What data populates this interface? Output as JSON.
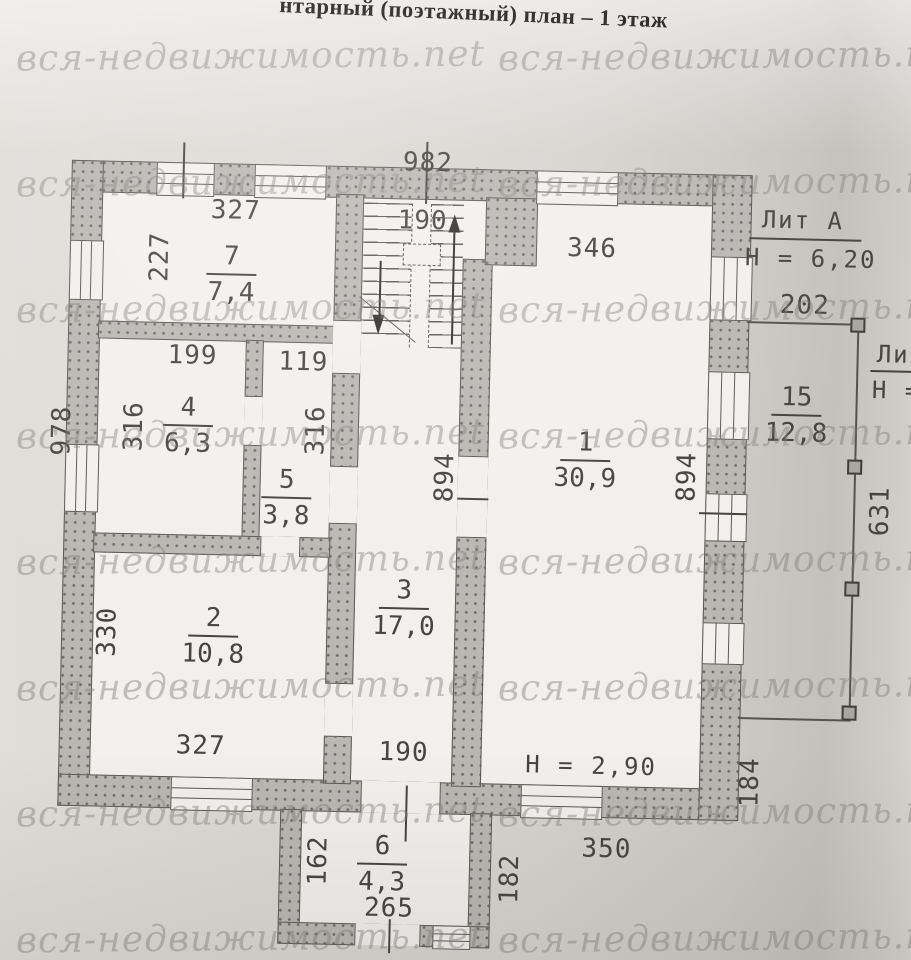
{
  "title": "нтарный (поэтажный) план – 1 этаж",
  "watermark": {
    "text": "вся-недвижимость.net"
  },
  "rooms": {
    "r1": {
      "number": "1",
      "area": "30,9"
    },
    "r2": {
      "number": "2",
      "area": "10,8"
    },
    "r3": {
      "number": "3",
      "area": "17,0"
    },
    "r4": {
      "number": "4",
      "area": "6,3"
    },
    "r5": {
      "number": "5",
      "area": "3,8"
    },
    "r6": {
      "number": "6",
      "area": "4,3"
    },
    "r7": {
      "number": "7",
      "area": "7,4"
    },
    "r15": {
      "number": "15",
      "area": "12,8"
    }
  },
  "dims": {
    "overall_top": "982",
    "room7_top": "327",
    "hall_top": "190",
    "room1_top": "346",
    "room7_left": "227",
    "room4_top": "199",
    "room5_top": "119",
    "room4_left": "316",
    "room5_right": "316",
    "overall_left": "978",
    "hall_right": "894",
    "room1_right": "894",
    "room2_left": "330",
    "room2_bottom": "327",
    "hall_bottom": "190",
    "room6_left": "162",
    "room6_bottom": "265",
    "room6_right": "182",
    "bottom_right": "350",
    "right_lower": "184",
    "porch_top": "202",
    "porch_right": "631"
  },
  "annotations": {
    "building_liter": "Лит А",
    "building_height": "Н = 6,20",
    "room1_height": "Н = 2,90",
    "porch_liter": "Лит",
    "porch_height": "Н ="
  },
  "colors": {
    "wall": "#b9b7b2",
    "line": "#55534f",
    "ink": "#45443f",
    "paper": "#d8d5d0",
    "drawing_paper": "#f2f0ec",
    "watermark": "#8a8782"
  }
}
